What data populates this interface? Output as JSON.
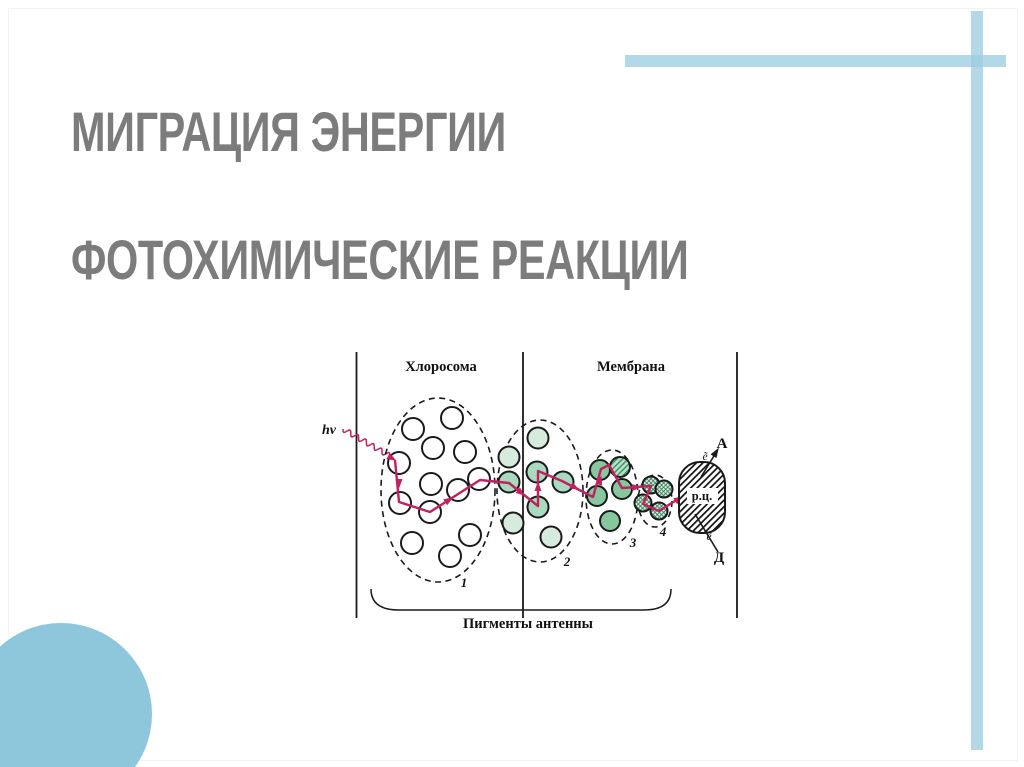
{
  "slide": {
    "title_line1": "МИГРАЦИЯ ЭНЕРГИИ",
    "title_line2": "ФОТОХИМИЧЕСКИЕ РЕАКЦИИ",
    "title_color": "#7c7c7c",
    "accent_bar_color": "#b3d8e8",
    "accent_overlap_color": "#a4cfe0",
    "accent_circle_color": "#8ec6dc"
  },
  "diagram": {
    "labels": {
      "section1": "Хлоросома",
      "section2": "Мембрана",
      "photon": "hν",
      "reaction_center": "р.ц.",
      "acceptor": "А",
      "donor": "Д",
      "electron": "ẽ",
      "antenna": "Пигменты антенны"
    },
    "colors": {
      "ink": "#1a1a1a",
      "path_magenta": "#c2205f",
      "g1_white": "#ffffff",
      "g2_pale_green": "#d7ebdc",
      "g2_mid_green": "#a9d9bf",
      "g3_green": "#86c79d"
    },
    "frame_y": [
      352,
      618
    ],
    "vlines": [
      356.5,
      523,
      737
    ],
    "sections": [
      {
        "label_key": "section1",
        "x": 441,
        "y": 371
      },
      {
        "label_key": "section2",
        "x": 631,
        "y": 371
      }
    ],
    "photon_label_pos": [
      336,
      434
    ],
    "squiggle": {
      "x1": 343,
      "y1": 429,
      "x2": 395,
      "y2": 459,
      "amp": 2.6,
      "wave": 9
    },
    "groups": [
      {
        "n": "1",
        "cx": 438,
        "cy": 490,
        "rx": 57,
        "ry": 92,
        "r": 11,
        "fill": "white",
        "num": [
          464,
          587
        ],
        "circles": [
          [
            413,
            429
          ],
          [
            452,
            418
          ],
          [
            433,
            448
          ],
          [
            465,
            452
          ],
          [
            399,
            463
          ],
          [
            431,
            484
          ],
          [
            458,
            490
          ],
          [
            479,
            479
          ],
          [
            400,
            503
          ],
          [
            430,
            512
          ],
          [
            412,
            543
          ],
          [
            450,
            556
          ],
          [
            470,
            535
          ]
        ]
      },
      {
        "n": "2",
        "cx": 540,
        "cy": 491,
        "rx": 43,
        "ry": 71,
        "r": 10.5,
        "fill": "pale",
        "num": [
          567,
          566
        ],
        "circles": [
          [
            538,
            438
          ],
          [
            509,
            457
          ],
          [
            509,
            482,
            "mid"
          ],
          [
            537,
            472,
            "mid"
          ],
          [
            538,
            507,
            "mid"
          ],
          [
            563,
            482,
            "mid"
          ],
          [
            513,
            523
          ],
          [
            551,
            537
          ]
        ]
      },
      {
        "n": "3",
        "cx": 612,
        "cy": 497,
        "rx": 26,
        "ry": 47,
        "r": 10,
        "fill": "green",
        "num": [
          633,
          547
        ],
        "circles": [
          [
            600,
            470
          ],
          [
            620,
            467,
            "ghatch"
          ],
          [
            597,
            496
          ],
          [
            622,
            489
          ],
          [
            610,
            521
          ]
        ]
      },
      {
        "n": "4",
        "cx": 655,
        "cy": 501,
        "rx": 17,
        "ry": 26,
        "r": 8.5,
        "fill": "cross",
        "num": [
          663,
          536
        ],
        "circles": [
          [
            651,
            485
          ],
          [
            664,
            489
          ],
          [
            643,
            503
          ],
          [
            659,
            511
          ]
        ]
      }
    ],
    "energy_path": [
      [
        395,
        460
      ],
      [
        399,
        502
      ],
      [
        430,
        512
      ],
      [
        480,
        480
      ],
      [
        509,
        483
      ],
      [
        538,
        506
      ],
      [
        538,
        471
      ],
      [
        562,
        481
      ],
      [
        593,
        497
      ],
      [
        601,
        469
      ],
      [
        609,
        465
      ],
      [
        622,
        488
      ],
      [
        651,
        486
      ],
      [
        643,
        504
      ],
      [
        659,
        511
      ],
      [
        683,
        496
      ]
    ],
    "path_arrows": [
      {
        "x": 395,
        "y": 460,
        "a": 30
      },
      {
        "x": 399,
        "y": 487,
        "a": 90
      },
      {
        "x": 452,
        "y": 498,
        "a": -33
      },
      {
        "x": 524,
        "y": 495,
        "a": 38
      },
      {
        "x": 538,
        "y": 483,
        "a": -90
      },
      {
        "x": 578,
        "y": 489,
        "a": 27
      },
      {
        "x": 601,
        "y": 477,
        "a": -74
      },
      {
        "x": 640,
        "y": 487,
        "a": -4
      },
      {
        "x": 682,
        "y": 497,
        "a": -32
      }
    ],
    "reaction_center": {
      "x": 679,
      "y": 462,
      "w": 46,
      "h": 71,
      "rx": 21,
      "label_pos": [
        702,
        500
      ],
      "label_box": [
        687,
        488,
        31,
        16
      ]
    },
    "acceptor_arrow": {
      "x1": 701,
      "y1": 477,
      "x2": 717,
      "y2": 451,
      "head": [
        718,
        449,
        -58
      ]
    },
    "donor_line": {
      "x1": 718,
      "y1": 552,
      "x2": 695,
      "y2": 514
    },
    "acceptor_label_pos": [
      722,
      448
    ],
    "donor_label_pos": [
      719,
      562
    ],
    "electron_top_pos": [
      705,
      460
    ],
    "electron_bottom_pos": [
      709,
      540
    ],
    "brace_path": "M371,589 Q371,610 399,610 L644,610 Q671,610 671,589",
    "antenna_label_pos": [
      528,
      628
    ]
  }
}
